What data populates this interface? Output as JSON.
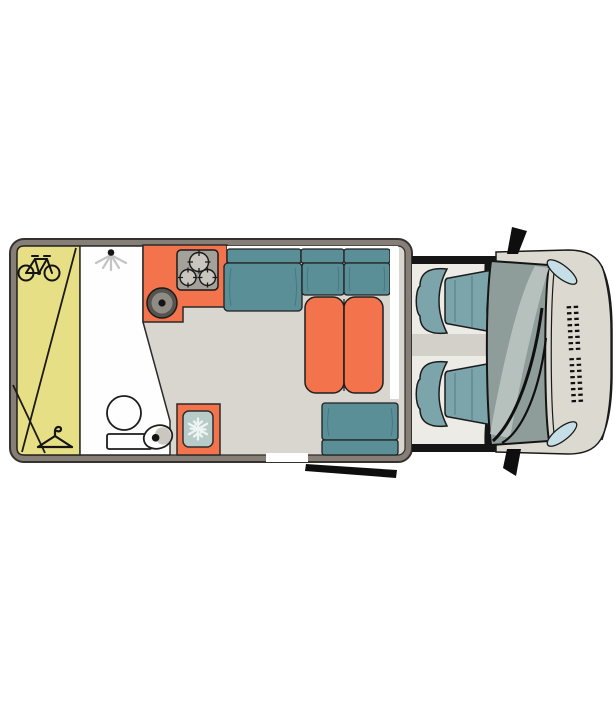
{
  "palette": {
    "page_bg": "#ffffff",
    "wall": "#867f77",
    "wall_outline": "#35322e",
    "floor": "#d9d6d0",
    "garage_yellow": "#e7df85",
    "bathroom_white": "#fefefe",
    "accent_orange": "#f3744c",
    "sofa_teal": "#5b8f98",
    "cab_seat_teal": "#7ba4ab",
    "stove_panel_gray": "#a4a19b",
    "burner_gray": "#c9c6c0",
    "sink_outer": "#57534e",
    "sink_inner": "#8f8c86",
    "fridge_panel": "#b7cbc8",
    "snowflake_white": "#eef4f2",
    "cab_floor": "#edebe6",
    "cab_dark": "#151515",
    "cab_divider": "#d3d0c9",
    "van_body": "#dcd9d1",
    "windshield": "#8e9d99",
    "windshield_highlight": "#bac5c1",
    "headlight_blue": "#c6dfe7",
    "black_detail": "#0e0e0e",
    "shower_ray_gray": "#c4c4c4",
    "basin_shadow": "#cac7c1",
    "outline_dark": "#1f1d1b"
  },
  "floor_plan": {
    "view": "top-down",
    "areas": {
      "garage": {
        "icons": [
          "bicycle-icon",
          "clothes-hanger-icon"
        ]
      },
      "bathroom": {
        "icons": [
          "shower-icon",
          "toilet-icon",
          "washbasin-icon"
        ]
      },
      "kitchen": {
        "icons": [
          "stove-icon",
          "sink-icon"
        ],
        "burner_count": 3
      },
      "refrigerator": {
        "icons": [
          "snowflake-icon"
        ]
      },
      "lounge": {
        "sofa_back_cushions": 3,
        "table_leaves": 2,
        "side_seat_cushions": 2
      },
      "cab": {
        "seats": [
          "driver-seat",
          "passenger-seat"
        ],
        "icons": [
          "steering-wheel-icon",
          "side-mirror-icon",
          "headlight",
          "front-grille"
        ]
      }
    }
  }
}
